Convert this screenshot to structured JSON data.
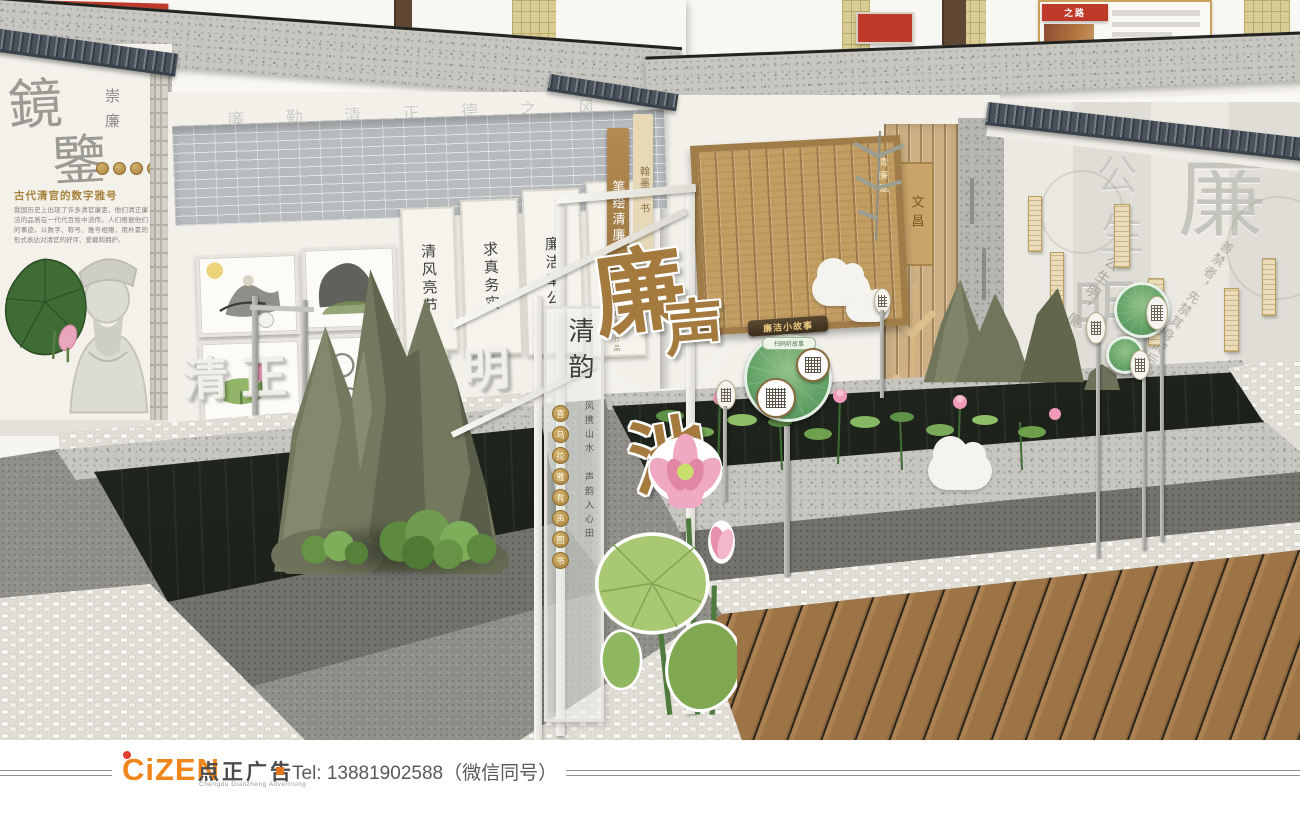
{
  "colors": {
    "accent_red": "#bf3a2b",
    "gold": "#b08a45",
    "leaf_green": "#5f9e63",
    "wood": "#c39e63",
    "logo_orange": "#f08519",
    "ink": "#3a3a35"
  },
  "footer": {
    "logo": "CiZEN",
    "logo_cn": "点正广告",
    "logo_sub": "Chengdu Dianzheng Advertising",
    "tel": "Tel: 13881902588（微信同号）"
  },
  "upper": {
    "ribbon": "之路"
  },
  "left_wall": {
    "title_top": "鏡",
    "title_bottom": "鑒",
    "side_label": "崇廉",
    "heading": "古代清官的数字雅号",
    "paragraph": "我国历史上出现了许多清官廉吏，他们清正廉洁的品质在一代代百姓中流传。人们根据他们的事迹，以数字、称号、雅号相赠，用朴素的形式表达对清官的好评、爱戴和拥护。"
  },
  "gallery": {
    "frieze": "廉 勤 清 正 德 之 风",
    "relief_1": "清",
    "relief_2": "正",
    "relief_3": "廉",
    "relief_4": "明",
    "scroll_1": "清风亮节",
    "scroll_2": "求真务实",
    "scroll_3": "廉洁奉公",
    "scroll_4": "两袖清风"
  },
  "center": {
    "tab_light": "翰墨·书",
    "tab_dark": "笔绘清廉",
    "tab_sub": "廉政书画作品",
    "pond_1": "廉",
    "pond_2": "声",
    "pond_3": "池",
    "glass_title": "清韵",
    "poem": "风携山水 声韵入心田",
    "m1": "喜",
    "m2": "马",
    "m3": "拉",
    "m4": "雅",
    "m5": "有",
    "m6": "声",
    "m7": "图",
    "m8": "书",
    "slips_title": "清廉赋",
    "screen_label": "文昌"
  },
  "right_wall": {
    "big_1": "公",
    "big_2": "生",
    "big_3": "明",
    "big_4": "廉",
    "phrase_1": "公生明，廉生威。",
    "phrase_2": "善禁者，先禁其身而后人。"
  },
  "signs": {
    "banner": "廉洁小故事",
    "sub": "扫码听故事"
  }
}
